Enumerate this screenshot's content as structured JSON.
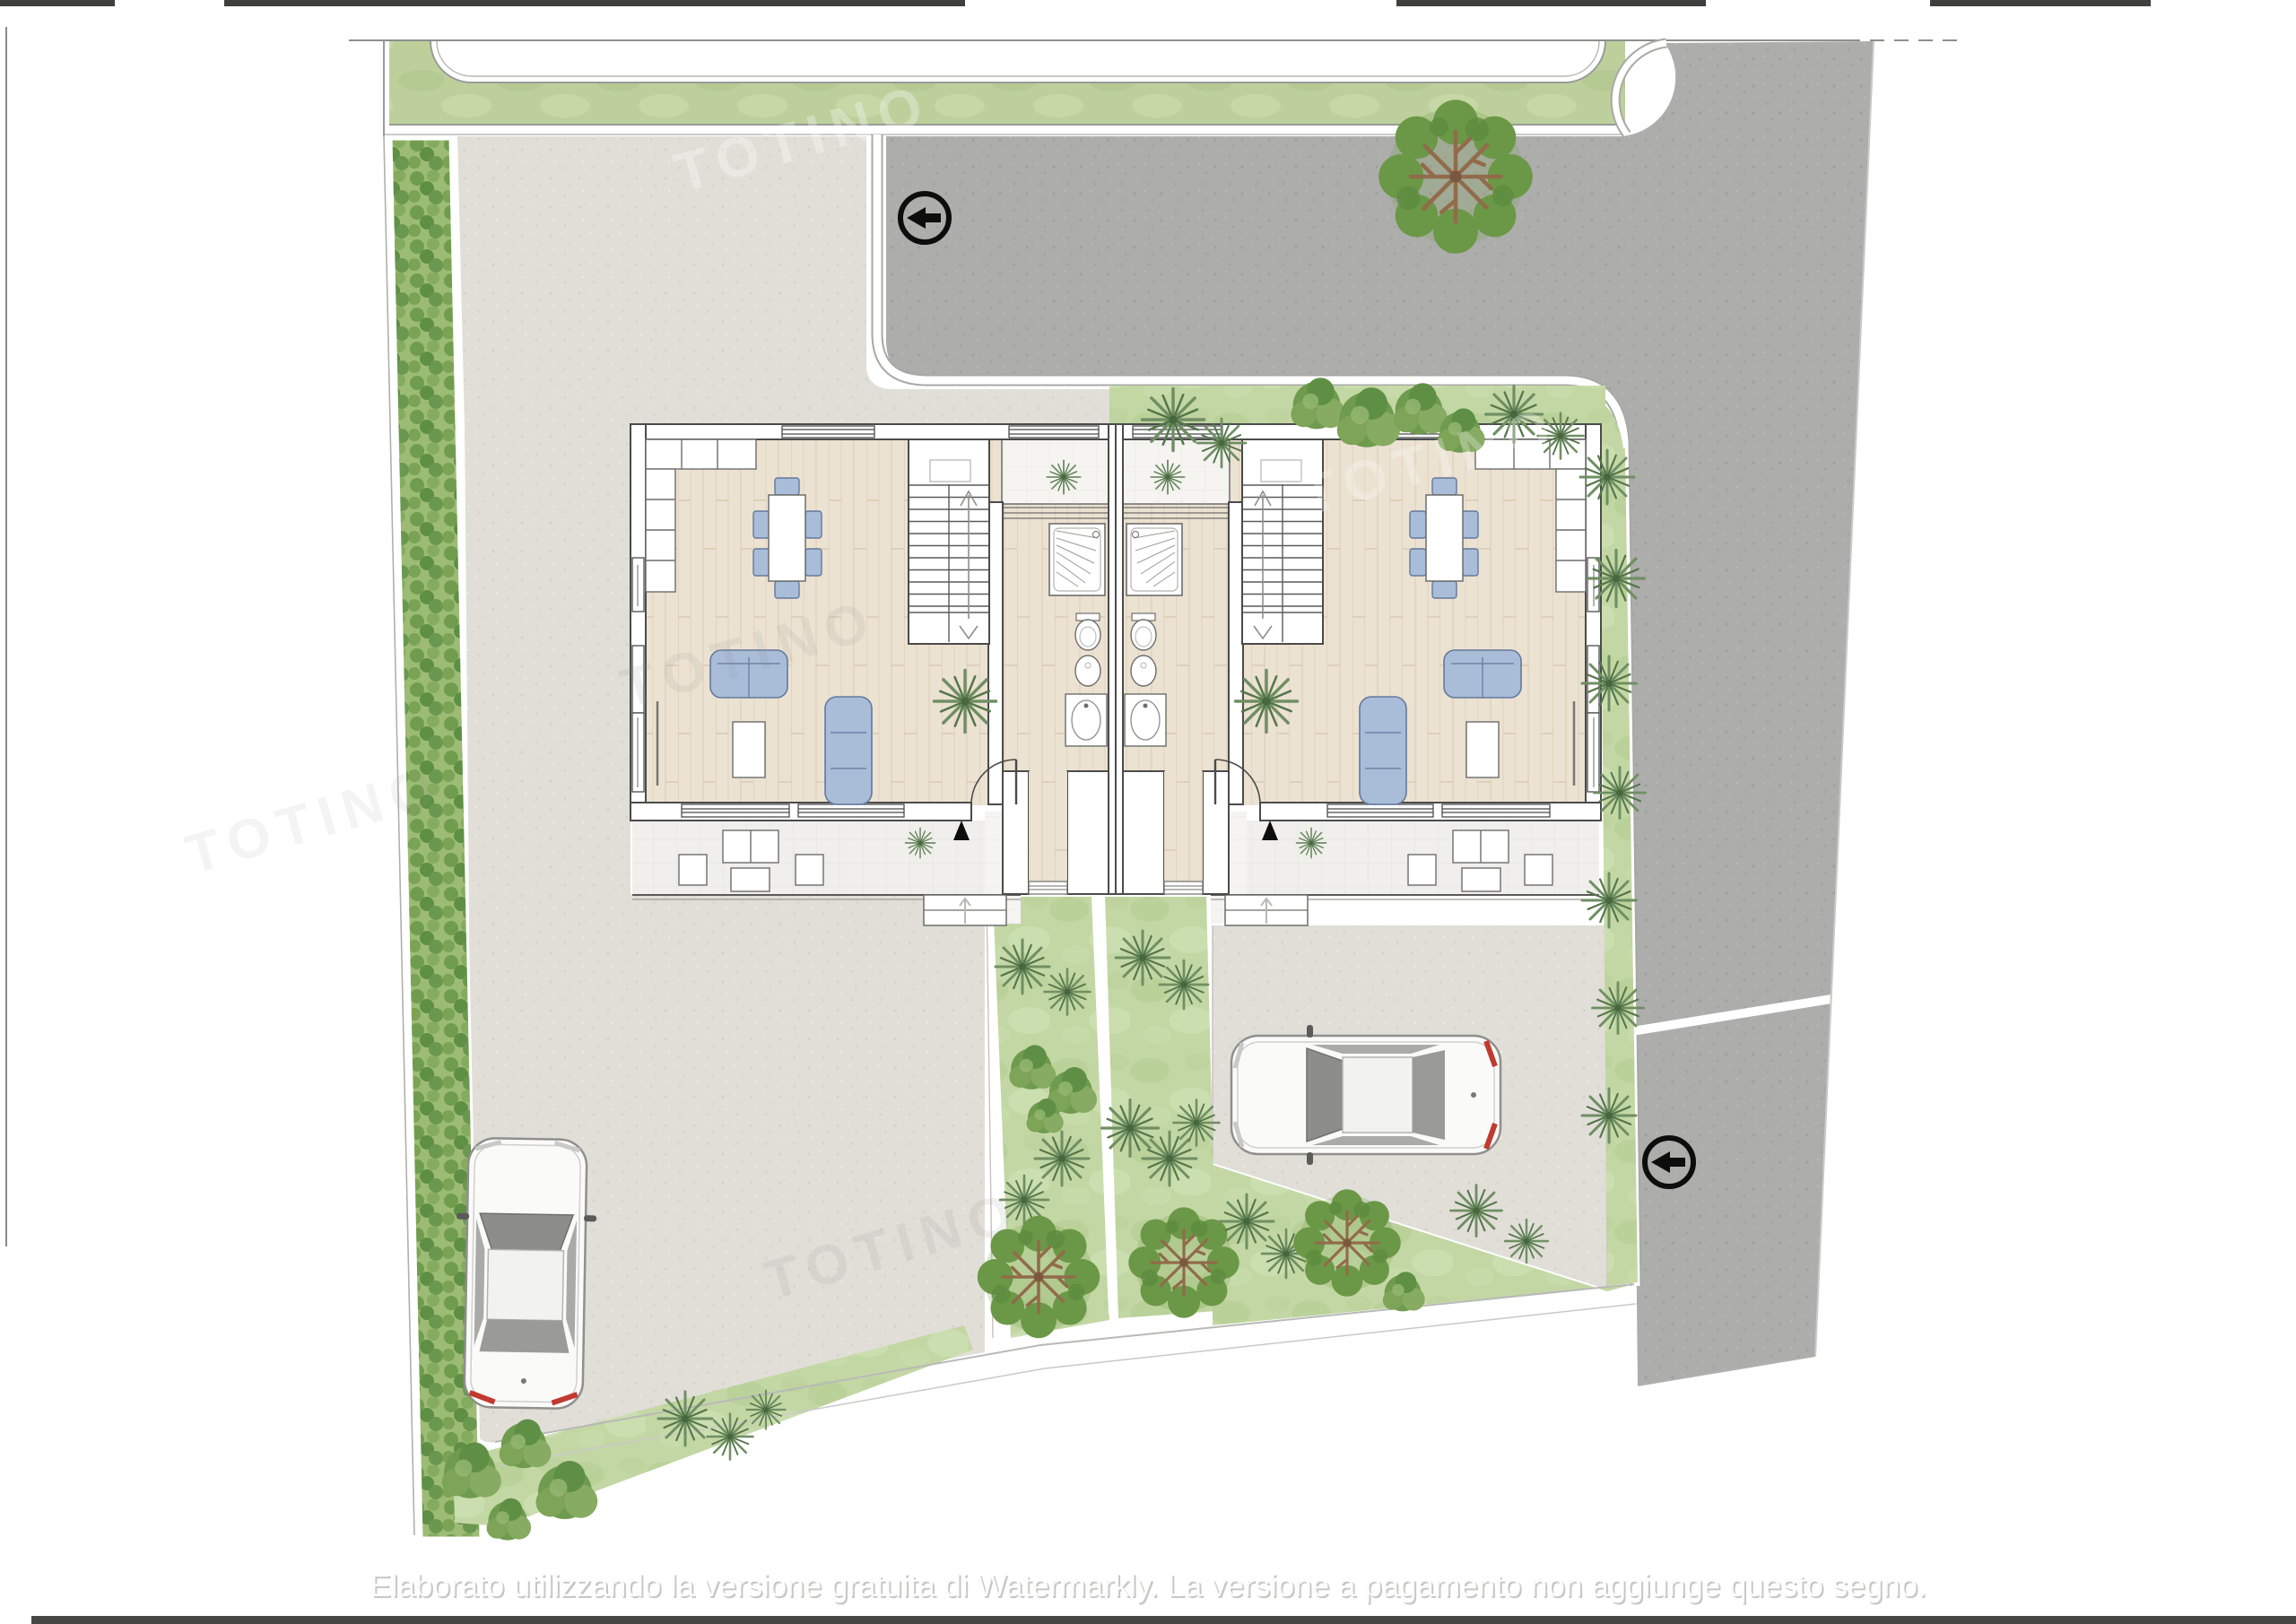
{
  "document": {
    "kind_label": "residential site plan / ground floor plan",
    "units_in_building": 2,
    "vehicles_shown": 2
  },
  "watermark": {
    "bottom_text": "Elaborato utilizzando la versione gratuita di Watermarkly. La versione a pagamento non aggiunge questo segno.",
    "diagonal_text": "TOTINO"
  },
  "icons": {
    "one_way_sign": "arrow-left-in-circle",
    "entrance_marker": "black-triangle-up",
    "stair_up": "arrow-up",
    "stair_down": "chevron-down"
  },
  "colors": {
    "asphalt_road": "#adadab",
    "paved_court": "#e1ded8",
    "lawn": "#c3d7a4",
    "sidewalk_lawn": "#bdd09c",
    "hedge": "#9cbb74",
    "wood_floor": "#ece2d2",
    "furniture_blue": "#a9bdd9",
    "wall_line": "#4b4b4b",
    "tail_light_red": "#c03a30"
  }
}
